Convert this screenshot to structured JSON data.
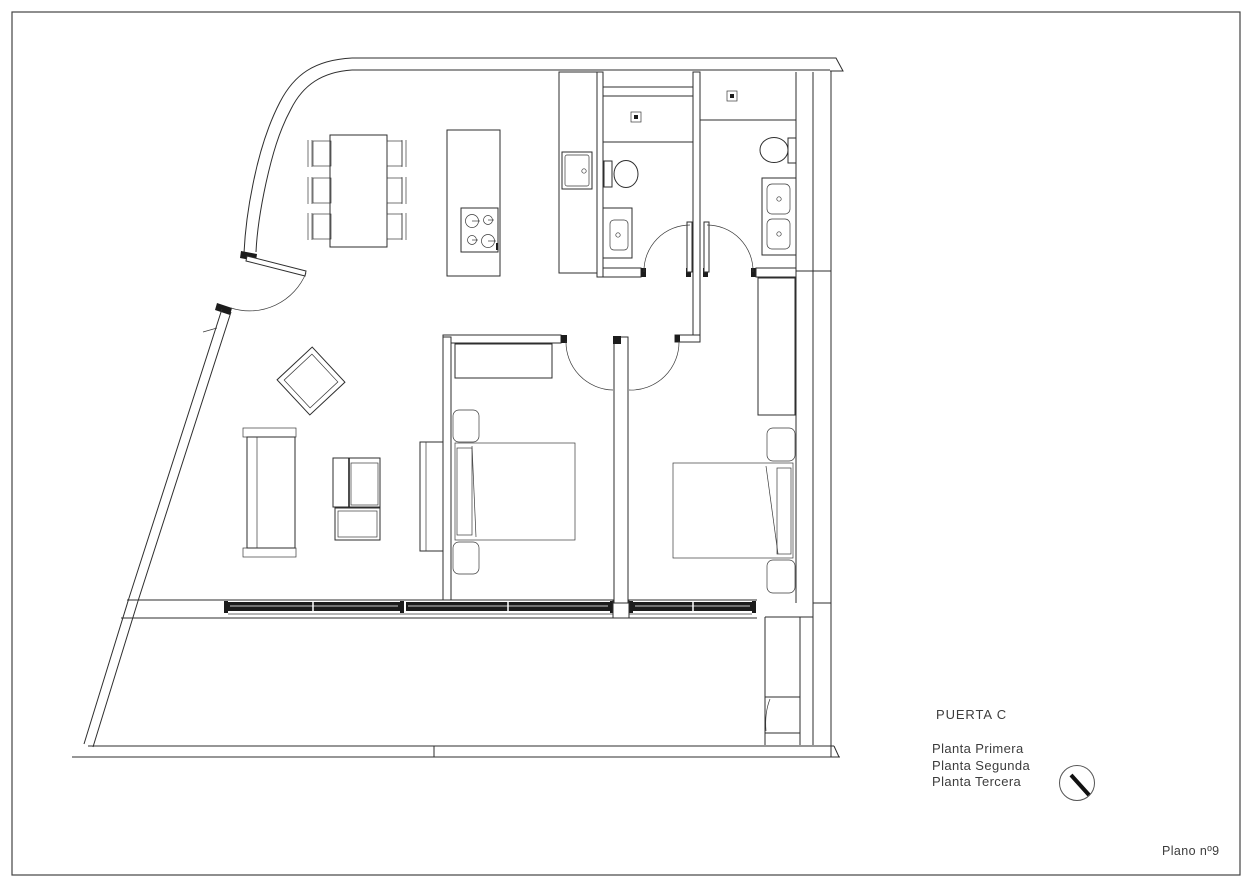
{
  "sheet": {
    "background": "#ffffff",
    "border_color": "#444444",
    "line_color": "#2e2e2e",
    "glazing_color": "#1c1c1c",
    "text_color": "#3c3c3c"
  },
  "title_block": {
    "unit_label": "PUERTA C",
    "floor_labels": [
      "Planta Primera",
      "Planta Segunda",
      "Planta Tercera"
    ],
    "sheet_label": "Plano nº9"
  },
  "drawing": {
    "rooms": [
      "kitchen-dining",
      "living-room",
      "hall",
      "bathroom-1",
      "bathroom-2",
      "bedroom-1",
      "bedroom-2",
      "terrace"
    ],
    "fixtures": [
      "dining-table-six-chairs",
      "kitchen-island-cooktop",
      "kitchen-sink",
      "shower-1",
      "toilet-1",
      "washbasin-1",
      "shower-2",
      "toilet-2",
      "double-washbasin",
      "armchair",
      "sofa",
      "coffee-table",
      "tv-unit",
      "bed-1",
      "closet-1",
      "nightstands-1",
      "bed-2",
      "wardrobe-2",
      "nightstands-2",
      "sliding-windows",
      "orientation-dial"
    ]
  }
}
